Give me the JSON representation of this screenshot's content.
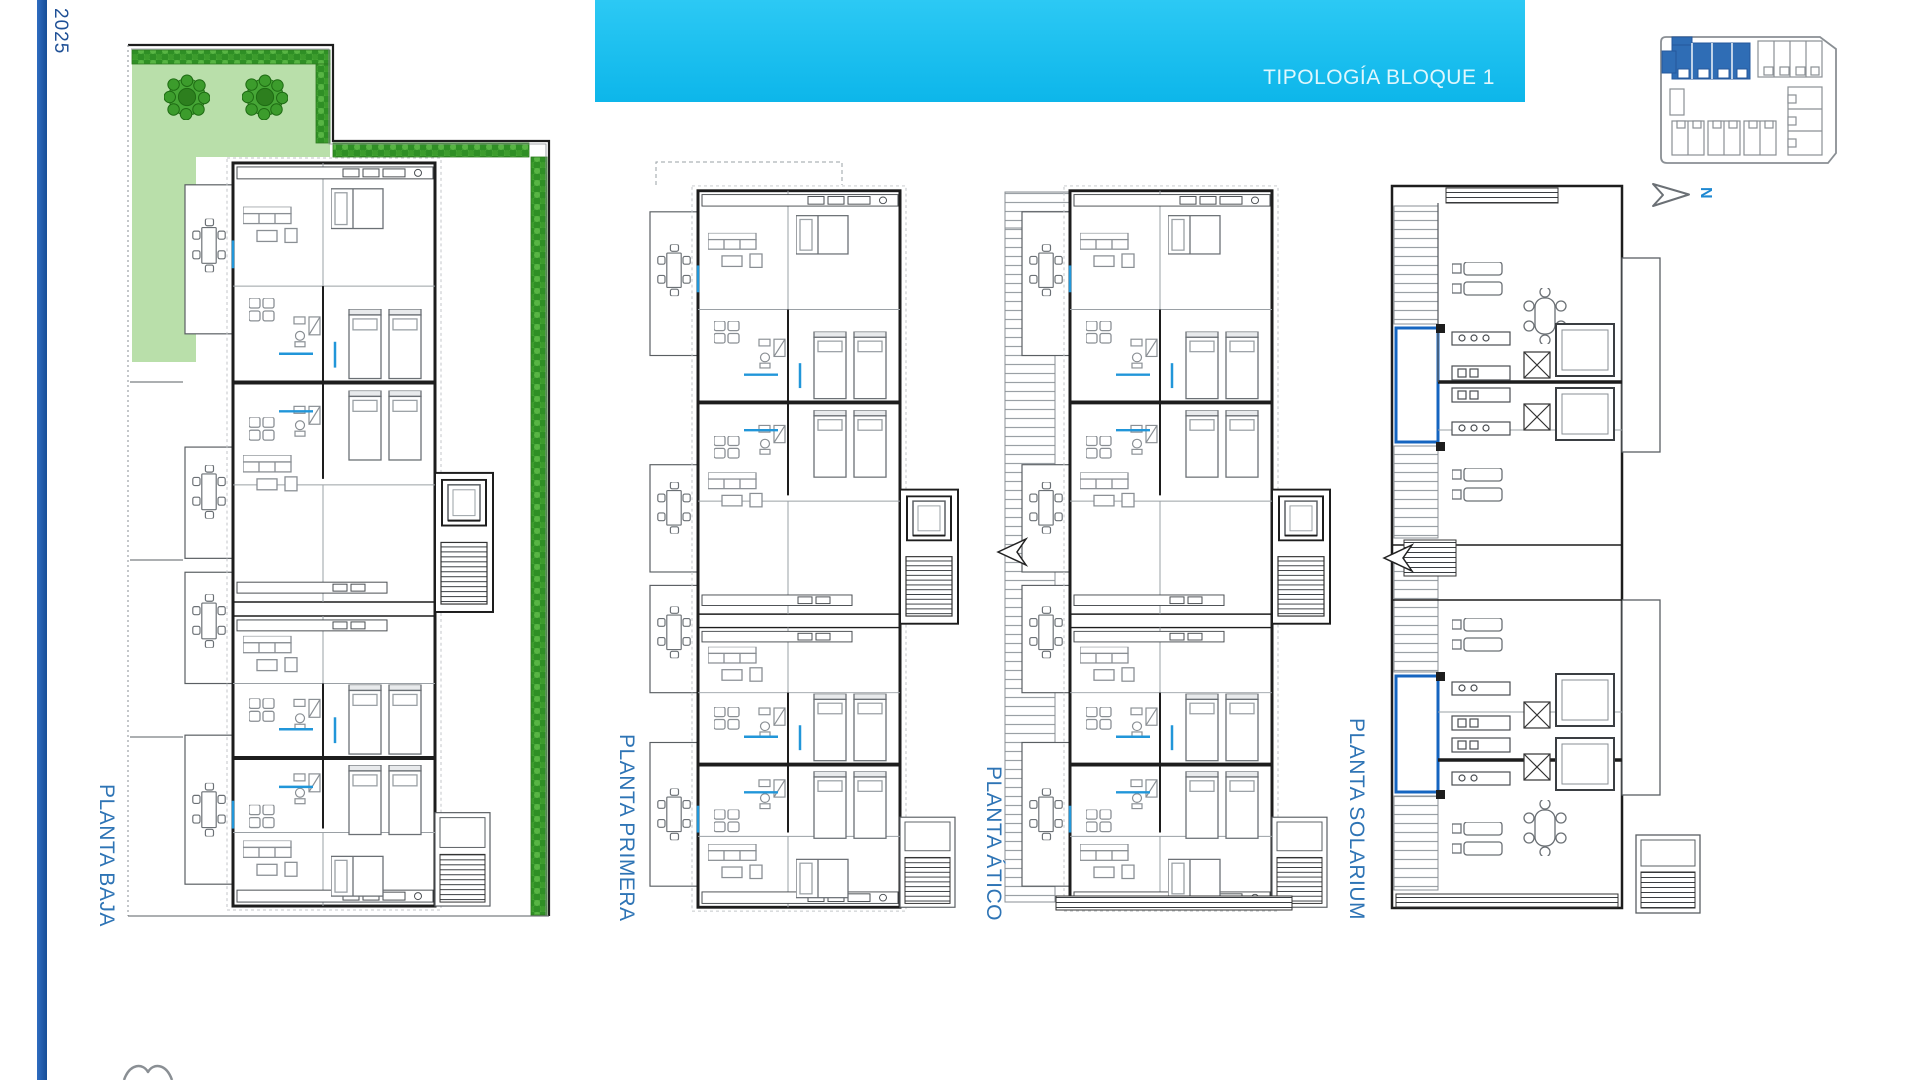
{
  "meta": {
    "year_label": "2025"
  },
  "header": {
    "title": "TIPOLOGÍA BLOQUE 1"
  },
  "plans": [
    {
      "id": "baja",
      "label": "PLANTA BAJA"
    },
    {
      "id": "primera",
      "label": "PLANTA PRIMERA"
    },
    {
      "id": "atico",
      "label": "PLANTA ÁTICO"
    },
    {
      "id": "solarium",
      "label": "PLANTA SOLARIUM"
    }
  ],
  "site_key": {
    "north_label": "N",
    "highlighted_block": "Bloque 1"
  },
  "colors": {
    "accent_cyan": "#18c0f0",
    "label_blue": "#2e74b5",
    "sidebar_blue": "#1d5aab",
    "site_key_highlight": "#2f6db5",
    "garden_green": "#b9dfaa",
    "hedge_green": "#46a636",
    "pool_blue": "#1565c0",
    "door_blue": "#2196d9"
  }
}
